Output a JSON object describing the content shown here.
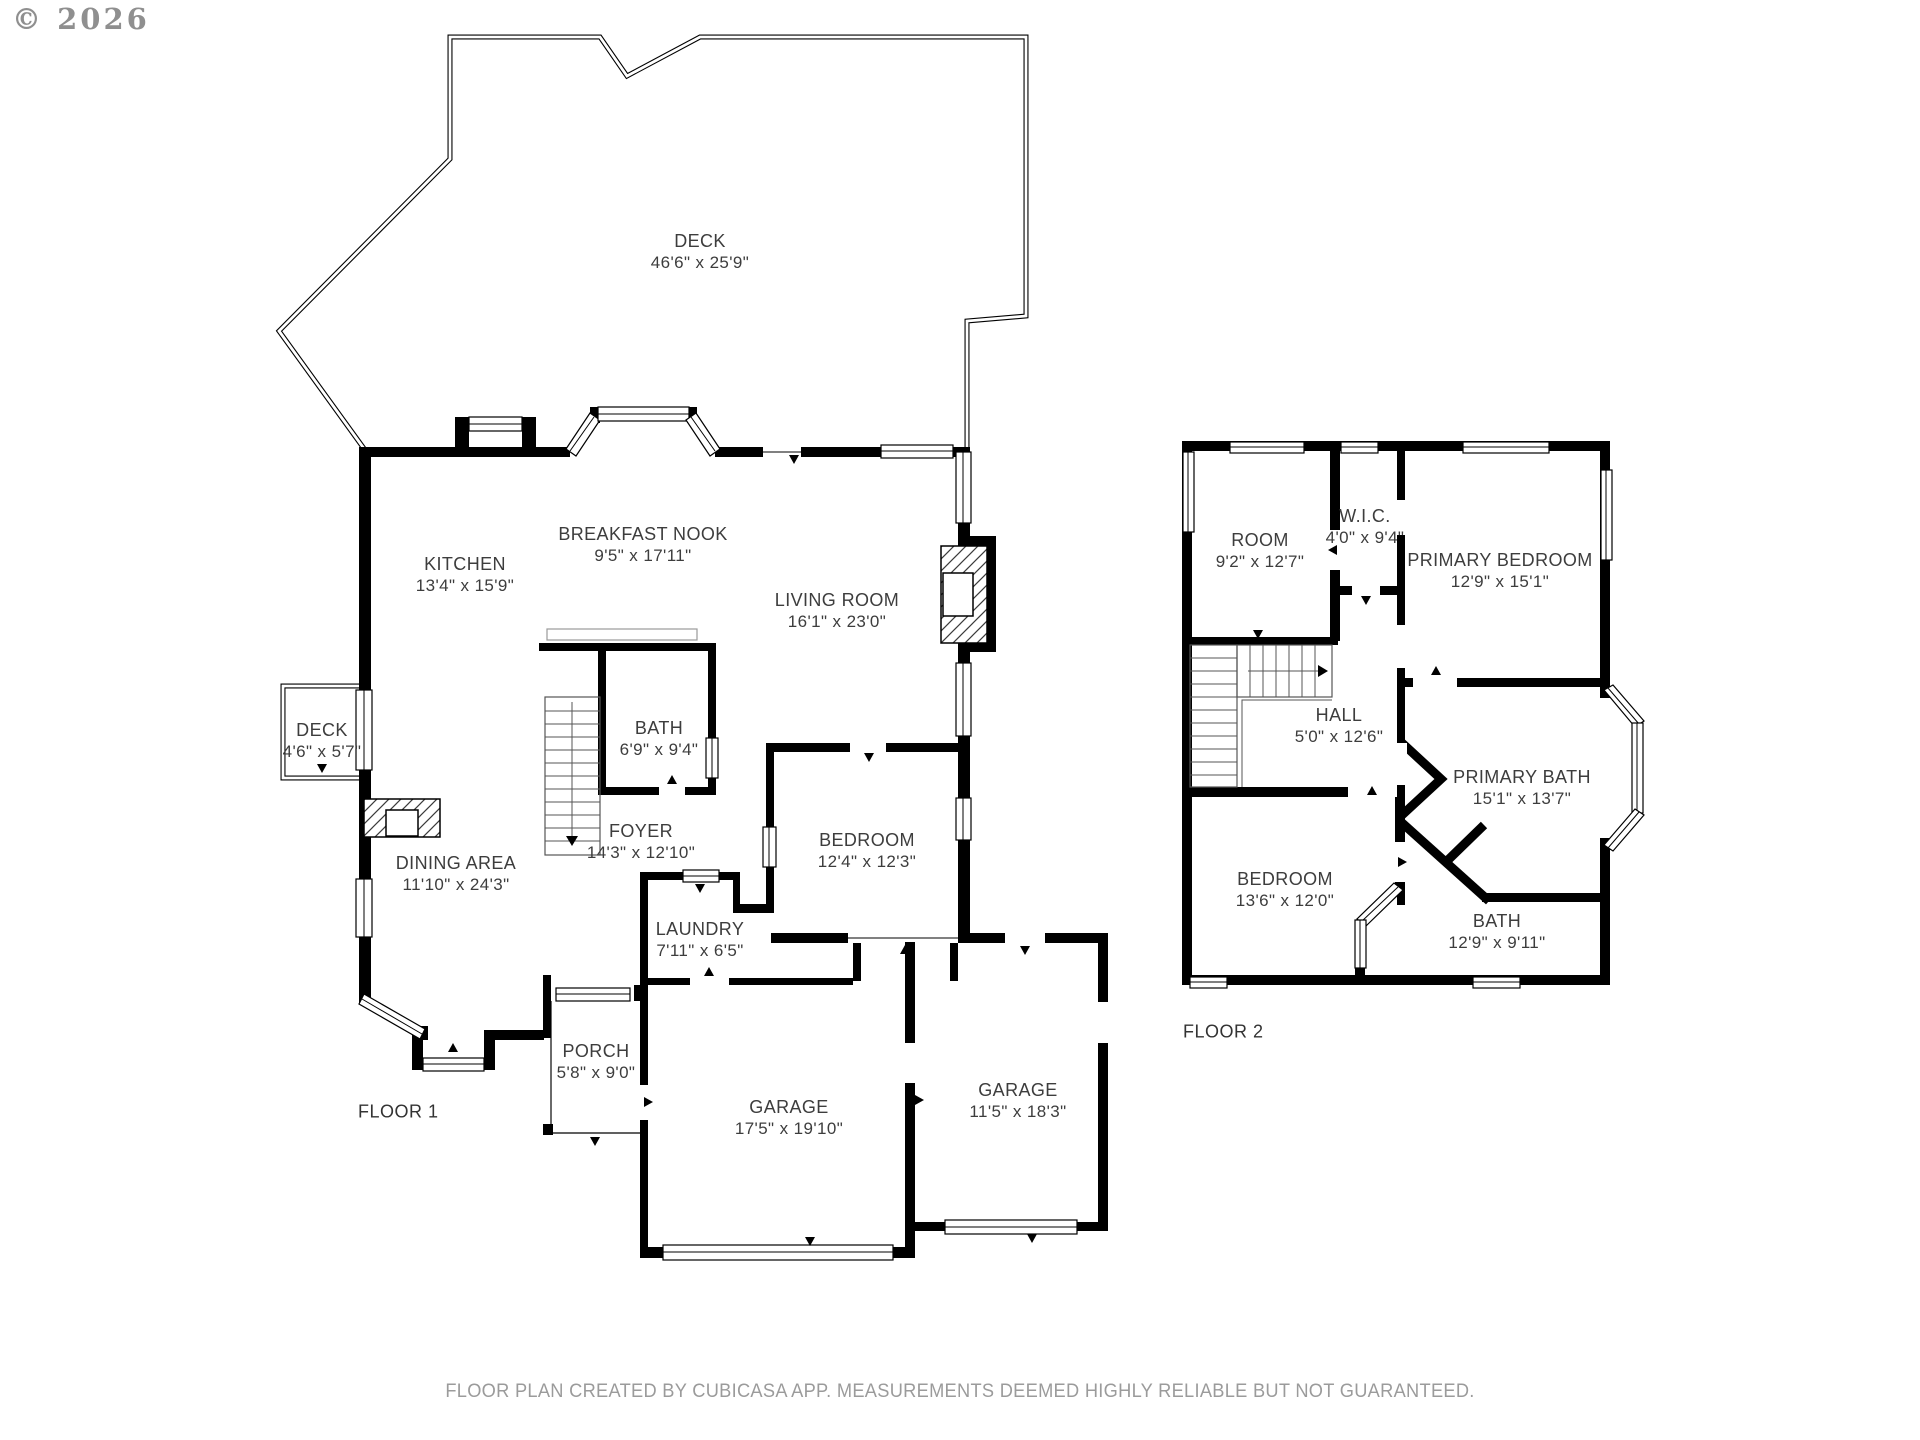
{
  "copyright": "© 2026",
  "footer": "FLOOR PLAN CREATED BY CUBICASA APP. MEASUREMENTS DEEMED HIGHLY RELIABLE BUT NOT GUARANTEED.",
  "floor1": {
    "label": "FLOOR 1",
    "rooms": [
      {
        "name": "DECK",
        "dims": "46'6\" x 25'9\""
      },
      {
        "name": "KITCHEN",
        "dims": "13'4\" x 15'9\""
      },
      {
        "name": "BREAKFAST NOOK",
        "dims": "9'5\" x 17'11\""
      },
      {
        "name": "LIVING ROOM",
        "dims": "16'1\" x 23'0\""
      },
      {
        "name": "BATH",
        "dims": "6'9\" x 9'4\""
      },
      {
        "name": "DECK",
        "dims": "4'6\" x 5'7\""
      },
      {
        "name": "FOYER",
        "dims": "14'3\" x 12'10\""
      },
      {
        "name": "DINING AREA",
        "dims": "11'10\" x 24'3\""
      },
      {
        "name": "BEDROOM",
        "dims": "12'4\" x 12'3\""
      },
      {
        "name": "LAUNDRY",
        "dims": "7'11\" x 6'5\""
      },
      {
        "name": "PORCH",
        "dims": "5'8\" x 9'0\""
      },
      {
        "name": "GARAGE",
        "dims": "17'5\" x 19'10\""
      },
      {
        "name": "GARAGE",
        "dims": "11'5\" x 18'3\""
      }
    ]
  },
  "floor2": {
    "label": "FLOOR 2",
    "rooms": [
      {
        "name": "ROOM",
        "dims": "9'2\" x 12'7\""
      },
      {
        "name": "W.I.C.",
        "dims": "4'0\" x 9'4\""
      },
      {
        "name": "PRIMARY BEDROOM",
        "dims": "12'9\" x 15'1\""
      },
      {
        "name": "HALL",
        "dims": "5'0\" x 12'6\""
      },
      {
        "name": "PRIMARY BATH",
        "dims": "15'1\" x 13'7\""
      },
      {
        "name": "BEDROOM",
        "dims": "13'6\" x 12'0\""
      },
      {
        "name": "BATH",
        "dims": "12'9\" x 9'11\""
      }
    ]
  }
}
